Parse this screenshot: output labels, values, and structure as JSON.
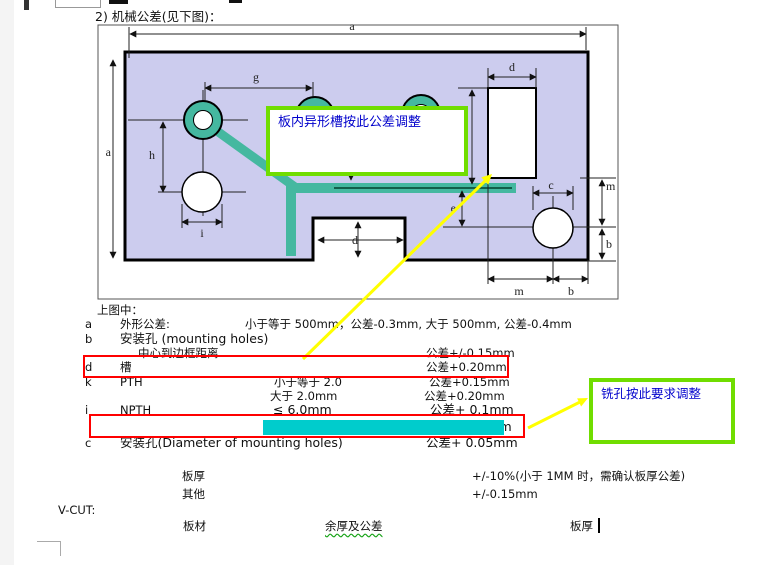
{
  "heading": "2) 机械公差(见下图)：",
  "diagram": {
    "dim_labels": {
      "a_top": "a",
      "a_left": "a",
      "g": "g",
      "h": "h",
      "i": "i",
      "d_slot": "d",
      "d_notch": "d",
      "e": "e",
      "c": "c",
      "m_right": "m",
      "b_right": "b",
      "m_bottom": "m",
      "b_bottom": "b"
    },
    "callout_slot": "板内异形槽按此公差调整",
    "callout_mill": "铣孔按此要求调整",
    "colors": {
      "board_fill": "#ccccee",
      "slot_teal": "#45b8a0",
      "callout_border": "#70dd00",
      "callout_text": "#0000cc",
      "highlight_cyan": "#00cccc",
      "attention_red": "#ff0000",
      "arrow_yellow": "#ffff00"
    }
  },
  "legend": {
    "intro": "上图中：",
    "rows": [
      {
        "key": "a",
        "label": "外形公差:",
        "cond": "小于等于 500mm，公差-0.3mm, 大于 500mm, 公差-0.4mm",
        "value": ""
      },
      {
        "key": "b",
        "label": "安装孔 (mounting holes)",
        "cond": "",
        "value": ""
      },
      {
        "key": "",
        "label": "中心到边框距离",
        "cond": "",
        "value": "公差+/-0.15mm"
      },
      {
        "key": "d",
        "label": "槽",
        "cond": "",
        "value": "公差+0.20mm"
      },
      {
        "key": "k",
        "label": "PTH",
        "cond": "小于等于 2.0",
        "value": "公差+0.15mm"
      },
      {
        "key": "",
        "label": "",
        "cond": "大于 2.0mm",
        "value": "公差+0.20mm"
      },
      {
        "key": "i",
        "label": "NPTH",
        "cond": "≤ 6.0mm",
        "value": "公差+ 0.1mm"
      },
      {
        "key": "",
        "label": "",
        "cond": "> 6.0mm",
        "value": "公差+ 0.2mm"
      },
      {
        "key": "c",
        "label": "安装孔(Diameter of mounting holes)",
        "cond": "",
        "value": "公差+ 0.05mm"
      }
    ]
  },
  "thickness": {
    "rows": [
      {
        "label": "板厚",
        "value": "+/-10%(小于 1MM 时，需确认板厚公差)"
      },
      {
        "label": "其他",
        "value": "+/-0.15mm"
      }
    ]
  },
  "vcut": {
    "label": "V-CUT:",
    "columns": [
      "板材",
      "余厚及公差",
      "板厚"
    ]
  }
}
